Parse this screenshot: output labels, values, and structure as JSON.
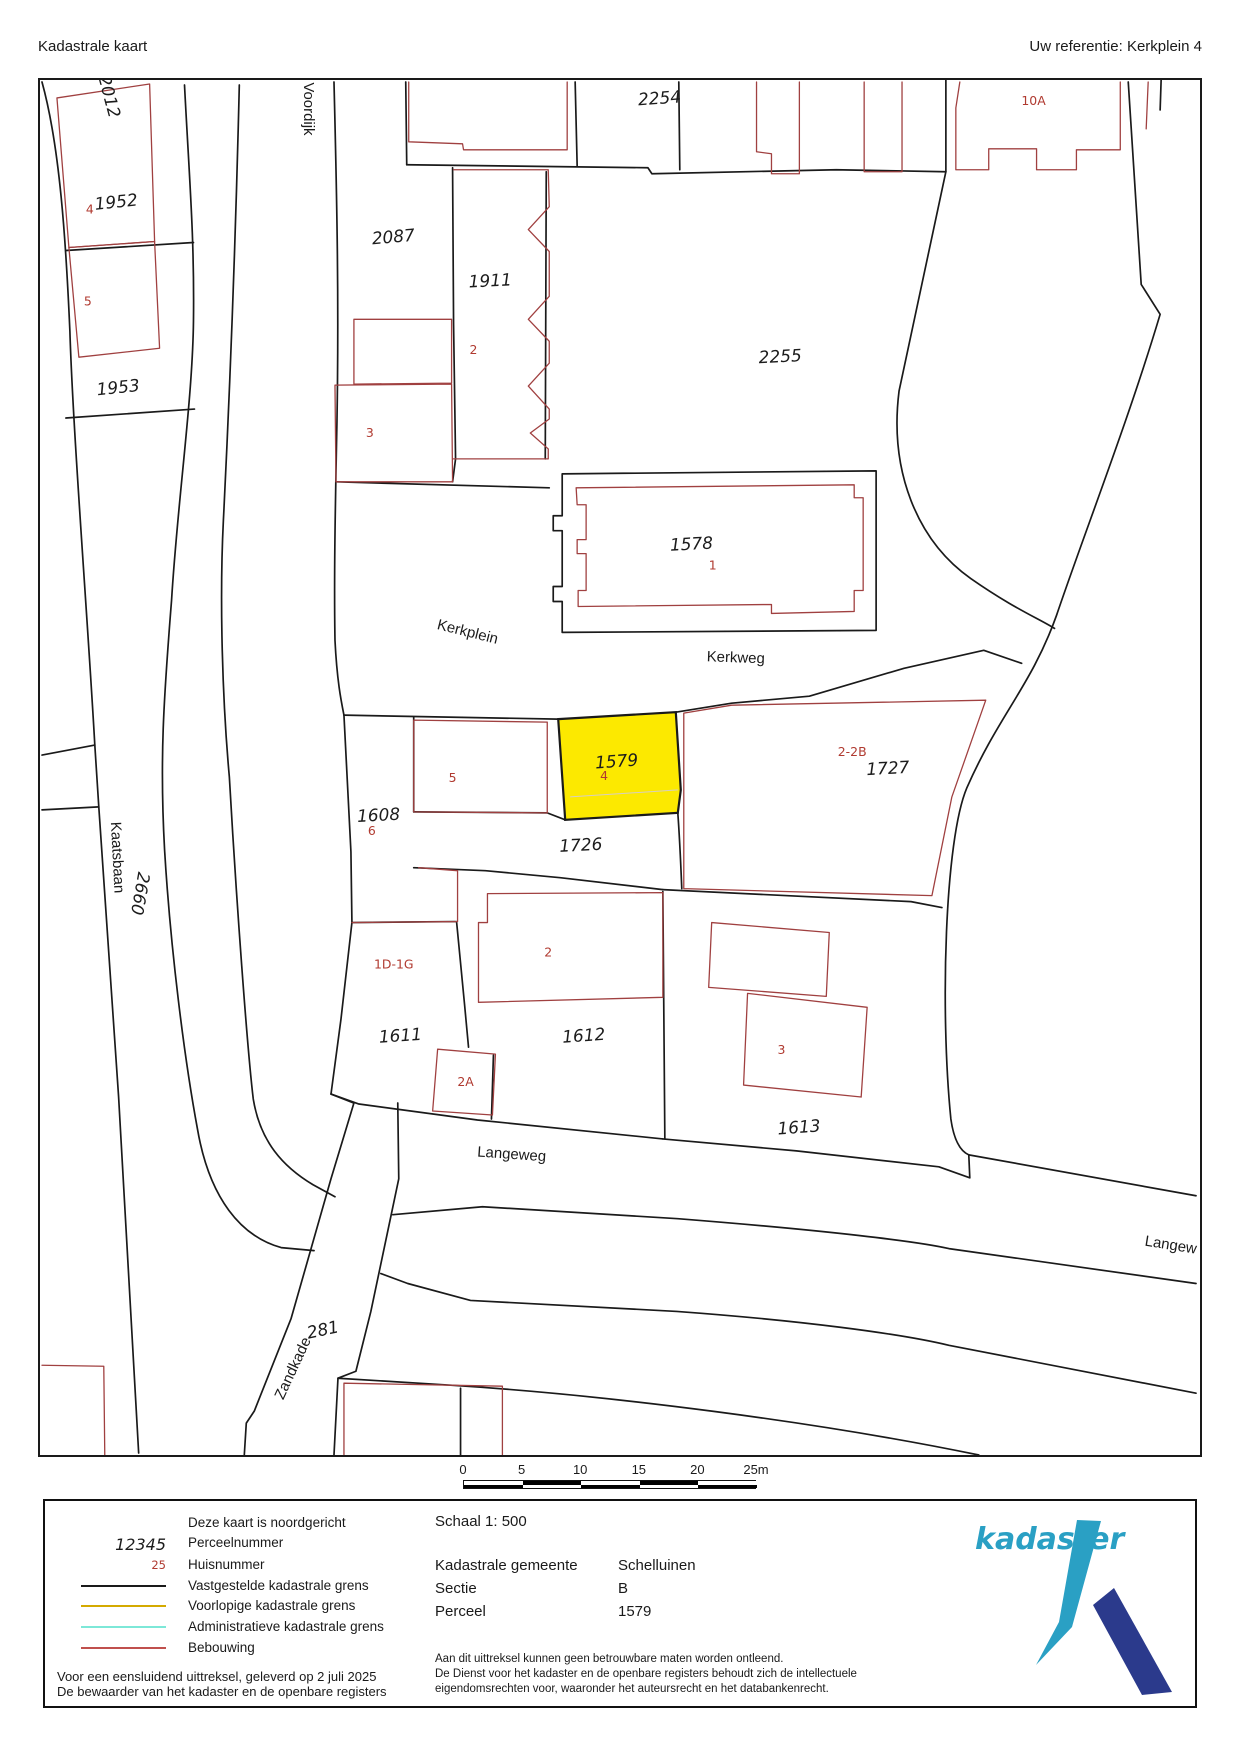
{
  "header": {
    "left": "Kadastrale kaart",
    "right": "Uw referentie: Kerkplein 4"
  },
  "map": {
    "highlighted_parcel": "1579",
    "colors": {
      "highlight": "#fce900",
      "boundary": "#1a1a1a",
      "building": "#a04040",
      "house_number": "#b03a30"
    },
    "parcel_labels": [
      {
        "text": "2012",
        "x": 102,
        "y": 96,
        "rot": 75
      },
      {
        "text": "1952",
        "x": 115,
        "y": 206,
        "rot": -6
      },
      {
        "text": "1953",
        "x": 117,
        "y": 392,
        "rot": -6
      },
      {
        "text": "2087",
        "x": 393,
        "y": 241,
        "rot": -5
      },
      {
        "text": "1911",
        "x": 490,
        "y": 285,
        "rot": -3
      },
      {
        "text": "2254",
        "x": 660,
        "y": 102,
        "rot": -4
      },
      {
        "text": "2255",
        "x": 781,
        "y": 361,
        "rot": -3
      },
      {
        "text": "1578",
        "x": 692,
        "y": 549,
        "rot": -3
      },
      {
        "text": "1579",
        "x": 617,
        "y": 767,
        "rot": -4
      },
      {
        "text": "1727",
        "x": 889,
        "y": 774,
        "rot": -3
      },
      {
        "text": "1726",
        "x": 581,
        "y": 851,
        "rot": -3
      },
      {
        "text": "1608",
        "x": 378,
        "y": 821,
        "rot": -3
      },
      {
        "text": "1611",
        "x": 400,
        "y": 1042,
        "rot": -4
      },
      {
        "text": "1612",
        "x": 584,
        "y": 1042,
        "rot": -4
      },
      {
        "text": "1613",
        "x": 800,
        "y": 1134,
        "rot": -4
      },
      {
        "text": "2660",
        "x": 133,
        "y": 893,
        "rot": 100
      },
      {
        "text": "281",
        "x": 323,
        "y": 1337,
        "rot": -12
      }
    ],
    "house_numbers": [
      {
        "text": "4",
        "x": 88,
        "y": 212,
        "rot": 0
      },
      {
        "text": "5",
        "x": 86,
        "y": 304,
        "rot": 0
      },
      {
        "text": "2",
        "x": 473,
        "y": 353,
        "rot": 0
      },
      {
        "text": "3",
        "x": 369,
        "y": 436,
        "rot": 0
      },
      {
        "text": "1",
        "x": 713,
        "y": 569,
        "rot": 0
      },
      {
        "text": "10A",
        "x": 1035,
        "y": 103,
        "rot": 0
      },
      {
        "text": "4",
        "x": 604,
        "y": 780,
        "rot": 0
      },
      {
        "text": "2-2B",
        "x": 853,
        "y": 756,
        "rot": 0
      },
      {
        "text": "6",
        "x": 371,
        "y": 835,
        "rot": 0
      },
      {
        "text": "5",
        "x": 452,
        "y": 782,
        "rot": 0
      },
      {
        "text": "1D-1G",
        "x": 393,
        "y": 969,
        "rot": 0
      },
      {
        "text": "2",
        "x": 548,
        "y": 957,
        "rot": 0
      },
      {
        "text": "2A",
        "x": 465,
        "y": 1087,
        "rot": 0
      },
      {
        "text": "3",
        "x": 782,
        "y": 1055,
        "rot": 0
      }
    ],
    "street_labels": [
      {
        "text": "Voordijk",
        "x": 303,
        "y": 107,
        "rot": 90
      },
      {
        "text": "Kaatsbaan",
        "x": 111,
        "y": 858,
        "rot": 87
      },
      {
        "text": "Kerkplein",
        "x": 466,
        "y": 636,
        "rot": 14
      },
      {
        "text": "Kerkweg",
        "x": 736,
        "y": 662,
        "rot": 2
      },
      {
        "text": "Langeweg",
        "x": 511,
        "y": 1160,
        "rot": 4
      },
      {
        "text": "Langew",
        "x": 1172,
        "y": 1251,
        "rot": 9
      },
      {
        "text": "Zandkade",
        "x": 296,
        "y": 1372,
        "rot": -65
      }
    ]
  },
  "scalebar": {
    "ticks": [
      "0",
      "5",
      "10",
      "15",
      "20",
      "25m"
    ],
    "segment_px": 58.6
  },
  "legend": {
    "rows": [
      {
        "sample_type": "none",
        "sample": "",
        "color": "",
        "label": "Deze kaart is noordgericht"
      },
      {
        "sample_type": "parcel-number",
        "sample": "12345",
        "color": "",
        "label": "Perceelnummer"
      },
      {
        "sample_type": "house-number",
        "sample": "25",
        "color": "",
        "label": "Huisnummer"
      },
      {
        "sample_type": "line",
        "sample": "",
        "color": "#1a1a1a",
        "label": "Vastgestelde kadastrale grens"
      },
      {
        "sample_type": "line",
        "sample": "",
        "color": "#d4aa00",
        "label": "Voorlopige kadastrale grens"
      },
      {
        "sample_type": "line",
        "sample": "",
        "color": "#7de8d8",
        "label": "Administratieve kadastrale grens"
      },
      {
        "sample_type": "line",
        "sample": "",
        "color": "#c0504d",
        "label": "Bebouwing"
      }
    ],
    "notes": [
      "Voor een eensluidend uittreksel, geleverd op 2 juli 2025",
      "De bewaarder van het kadaster en de openbare registers"
    ]
  },
  "info": {
    "schaal": "Schaal 1: 500",
    "rows": [
      {
        "label": "Kadastrale gemeente",
        "value": "Schelluinen"
      },
      {
        "label": "Sectie",
        "value": "B"
      },
      {
        "label": "Perceel",
        "value": "1579"
      }
    ],
    "disclaimer": [
      "Aan dit uittreksel kunnen geen betrouwbare maten worden ontleend.",
      "De Dienst voor het kadaster en de openbare registers behoudt zich de intellectuele",
      "eigendomsrechten voor, waaronder het auteursrecht en het databankenrecht."
    ]
  },
  "logo": {
    "text": "kadaster",
    "teal": "#2aa0c4",
    "navy": "#2b3a8c"
  }
}
